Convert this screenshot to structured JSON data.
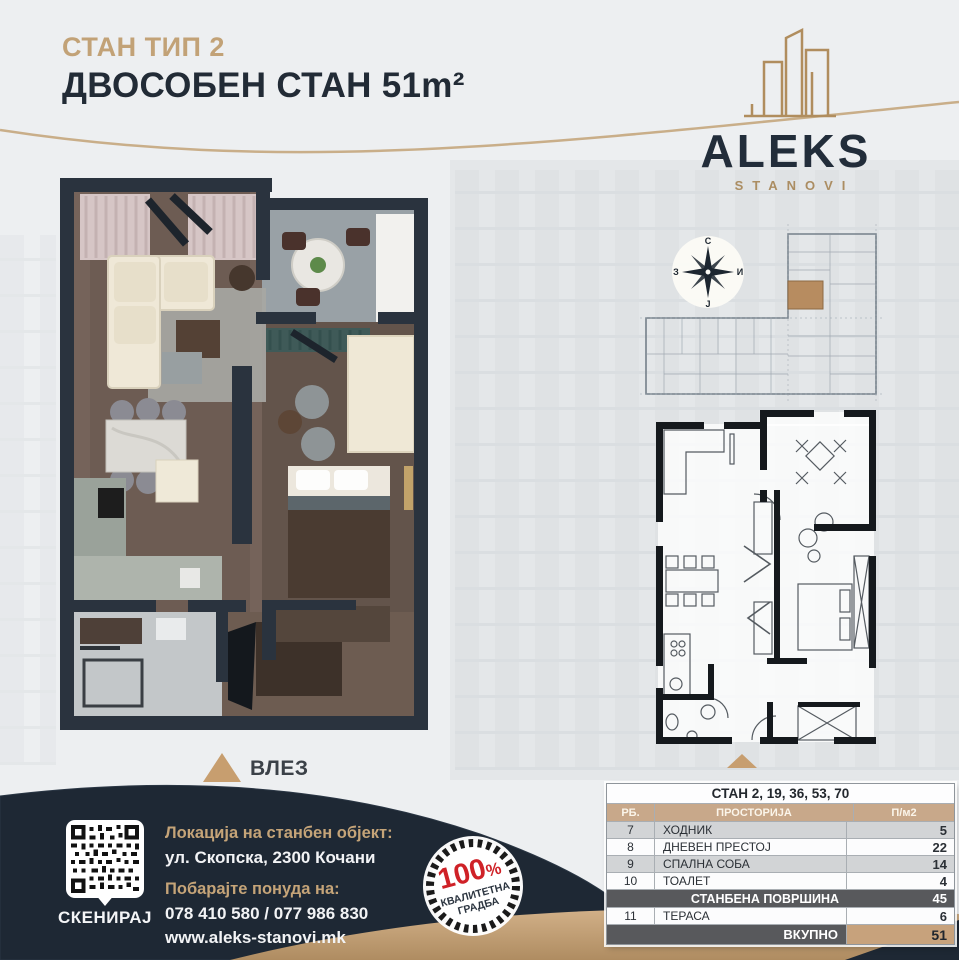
{
  "header": {
    "subtitle": "СТАН ТИП 2",
    "title": "ДВОСОБЕН СТАН 51m²"
  },
  "logo": {
    "name": "ALEKS",
    "tagline": "STANOVI"
  },
  "compass": {
    "north": "С",
    "east": "И",
    "south": "Ј",
    "west": "З"
  },
  "plan": {
    "entrance_label": "ВЛЕЗ"
  },
  "table": {
    "title": "СТАН 2, 19, 36, 53, 70",
    "columns": {
      "num": "РБ.",
      "room": "ПРОСТОРИЈА",
      "area": "П/м2"
    },
    "rows": [
      {
        "num": "7",
        "name": "ХОДНИК",
        "area": "5"
      },
      {
        "num": "8",
        "name": "ДНЕВЕН ПРЕСТОЈ",
        "area": "22"
      },
      {
        "num": "9",
        "name": "СПАЛНА СОБА",
        "area": "14"
      },
      {
        "num": "10",
        "name": "ТОАЛЕТ",
        "area": "4"
      }
    ],
    "subtotal": {
      "label": "СТАНБЕНА ПОВРШИНА",
      "area": "45"
    },
    "extra": {
      "num": "11",
      "name": "ТЕРАСА",
      "area": "6"
    },
    "total": {
      "label": "ВКУПНО",
      "area": "51"
    }
  },
  "footer": {
    "scan_label": "СКЕНИРАЈ",
    "location_label": "Локација на станбен објект:",
    "address": "ул. Скопска, 2300 Кочани",
    "offer_label": "Побарајте понуда на:",
    "phones": "078 410 580 / 077 986 830",
    "website": "www.aleks-stanovi.mk"
  },
  "badge": {
    "value": "100",
    "percent": "%",
    "line1": "КВАЛИТЕТНА",
    "line2": "ГРАДБА"
  },
  "colors": {
    "gold": "#c2a277",
    "navy": "#222d3a",
    "red": "#cf2127",
    "table_header": "#c8a88a",
    "dark_row": "#58595c",
    "total_cell": "#c7a27c",
    "highlight_unit": "#b78c60"
  }
}
